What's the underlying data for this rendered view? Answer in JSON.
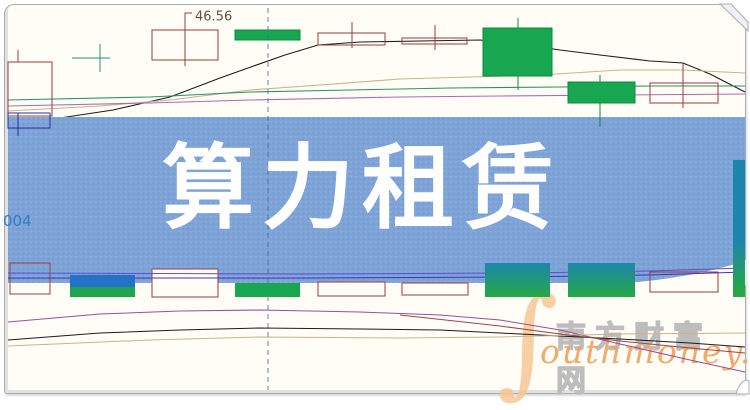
{
  "banner": {
    "title": "算力租赁",
    "bg": "#7da2d8",
    "text_color": "#ffffff"
  },
  "annotations": {
    "price_label": "46.56",
    "code_label": "004"
  },
  "watermark": {
    "swoosh": "∫",
    "cn": "南方财富网",
    "en": "outhmoney.com"
  },
  "colors": {
    "chart_bg": "#fffdf6",
    "frame": "#a8adb5",
    "banner": "#7da2d8",
    "up_outline": "#9a3c3a",
    "down_fill": "#18a750",
    "down_edge": "#0d8a3c",
    "navy": "#2b2f9e",
    "doji": "#2e8b80",
    "blue_bar": "#2472c8",
    "green_bar": "#1ea44e",
    "ma_black": "#1c1c1c",
    "ma_tan": "#c9b387",
    "ma_green": "#2f9068",
    "ma_pink": "#b06ab0",
    "purple1": "#5a4fd0",
    "purple2": "#3f35b5",
    "dashed": "#456e9e",
    "bot_purple": "#9a4f9a",
    "bot_black": "#1c1c1c",
    "bot_tan": "#c9b387",
    "bot_red": "#a04545",
    "label": "#6b4a45",
    "code": "#2a7fc0",
    "wm_orange": "#f0a25c",
    "wm_gray": "#bdbdbd"
  },
  "chart_data": {
    "type": "candlestick",
    "title": "算力租赁",
    "note": "Daily stock candlestick chart with MA lines; price axis hidden by blue banner overlay. Only visible price marker is 46.56. Coordinates below are pixel positions (y grows downward).",
    "visible_values": {
      "price_marker": 46.56
    },
    "banner_band": {
      "y": 117,
      "h": 166
    },
    "banner_curve_path": "M598,285 C660,282 715,272 746,260 L746,285 Z",
    "divider_x": 268,
    "price_leader": [
      [
        185,
        24
      ],
      [
        185,
        13
      ],
      [
        192,
        13
      ]
    ],
    "price_label_pos": [
      195,
      17
    ],
    "code_pos": [
      3,
      226
    ],
    "upper_lines": [
      {
        "name": "ma-black",
        "color": "ma_black",
        "points": [
          [
            8,
            124
          ],
          [
            60,
            118
          ],
          [
            113,
            110
          ],
          [
            170,
            97
          ],
          [
            220,
            78
          ],
          [
            248,
            68
          ],
          [
            285,
            55
          ],
          [
            318,
            45
          ],
          [
            360,
            42
          ],
          [
            420,
            41
          ],
          [
            480,
            40
          ],
          [
            520,
            44
          ],
          [
            560,
            50
          ],
          [
            600,
            55
          ],
          [
            650,
            61
          ],
          [
            683,
            63
          ],
          [
            710,
            74
          ],
          [
            745,
            92
          ]
        ]
      },
      {
        "name": "ma-tan",
        "color": "ma_tan",
        "points": [
          [
            8,
            111
          ],
          [
            100,
            106
          ],
          [
            170,
            100
          ],
          [
            250,
            90
          ],
          [
            320,
            85
          ],
          [
            400,
            79
          ],
          [
            470,
            77
          ],
          [
            540,
            75
          ],
          [
            620,
            70
          ],
          [
            683,
            70
          ],
          [
            745,
            73
          ]
        ]
      },
      {
        "name": "ma-green",
        "color": "ma_green",
        "points": [
          [
            8,
            100
          ],
          [
            150,
            97
          ],
          [
            250,
            92
          ],
          [
            350,
            90
          ],
          [
            450,
            88
          ],
          [
            560,
            87
          ],
          [
            650,
            86
          ],
          [
            745,
            86
          ]
        ]
      },
      {
        "name": "ma-pink",
        "color": "ma_pink",
        "points": [
          [
            8,
            106
          ],
          [
            150,
            103
          ],
          [
            250,
            100
          ],
          [
            400,
            97
          ],
          [
            500,
            96
          ],
          [
            620,
            95
          ],
          [
            745,
            94
          ]
        ]
      }
    ],
    "upper_candles": [
      {
        "kind": "up",
        "x": 8,
        "w": 44,
        "body": [
          62,
          116
        ],
        "wx": 18,
        "wick": [
          50,
          62
        ]
      },
      {
        "type": "doji",
        "hx": [
          72,
          110
        ],
        "hy": 58,
        "vx": 100,
        "vy": [
          44,
          72
        ]
      },
      {
        "kind": "up",
        "x": 152,
        "w": 66,
        "body": [
          30,
          60
        ],
        "wx": 185,
        "wick": [
          14,
          66
        ]
      },
      {
        "kind": "down",
        "x": 235,
        "w": 65,
        "body": [
          30,
          40
        ]
      },
      {
        "kind": "up",
        "x": 318,
        "w": 67,
        "body": [
          33,
          45
        ],
        "wx": 352,
        "wick": [
          22,
          48
        ]
      },
      {
        "kind": "up",
        "x": 402,
        "w": 65,
        "body": [
          38,
          44
        ],
        "wx": 435,
        "wick": [
          25,
          50
        ]
      },
      {
        "kind": "down",
        "x": 483,
        "w": 69,
        "body": [
          28,
          76
        ],
        "wx": 518,
        "wick": [
          18,
          90
        ]
      },
      {
        "kind": "down",
        "x": 568,
        "w": 67,
        "body": [
          82,
          103
        ],
        "wx": 600,
        "wick": [
          75,
          117
        ]
      },
      {
        "kind": "up",
        "x": 650,
        "w": 68,
        "body": [
          83,
          103
        ],
        "wx": 683,
        "wick": [
          63,
          108
        ]
      }
    ],
    "over_candles": [
      {
        "kind": "navy",
        "x": 8,
        "w": 42,
        "body": [
          113,
          128
        ],
        "wx": 18,
        "wick": [
          113,
          136
        ]
      },
      {
        "type": "seg",
        "x": 600,
        "y": [
          117,
          127
        ],
        "color": "down_edge"
      },
      {
        "kind": "grad",
        "x": 733,
        "w": 12,
        "body": [
          160,
          297
        ]
      }
    ],
    "purple_lines": [
      {
        "name": "overlay-line-1",
        "color": "purple1",
        "points": [
          [
            8,
            273
          ],
          [
            300,
            274
          ],
          [
            520,
            273
          ],
          [
            650,
            271
          ],
          [
            745,
            268
          ]
        ]
      },
      {
        "name": "overlay-line-2",
        "color": "purple2",
        "points": [
          [
            8,
            278
          ],
          [
            300,
            278
          ],
          [
            520,
            277
          ],
          [
            650,
            275
          ],
          [
            745,
            272
          ]
        ]
      }
    ],
    "lower_bars": [
      {
        "kind": "hollow",
        "fill": "none",
        "x": 10,
        "w": 40,
        "y": 263,
        "h": 31
      },
      {
        "kind": "bluegreen",
        "x": 70,
        "w": 65,
        "blue": [
          275,
          287
        ],
        "green": [
          287,
          297
        ]
      },
      {
        "kind": "hollow",
        "fill": "bg",
        "x": 152,
        "w": 66,
        "y": 269,
        "h": 28
      },
      {
        "kind": "green",
        "x": 235,
        "w": 65,
        "y": 283,
        "h": 14
      },
      {
        "kind": "hollow",
        "fill": "bg",
        "x": 318,
        "w": 67,
        "y": 282,
        "h": 14
      },
      {
        "kind": "hollow",
        "fill": "bg",
        "x": 402,
        "w": 66,
        "y": 283,
        "h": 12
      },
      {
        "kind": "grad",
        "x": 485,
        "w": 65,
        "y": 263,
        "h": 34
      },
      {
        "kind": "grad",
        "x": 568,
        "w": 67,
        "y": 263,
        "h": 34
      },
      {
        "kind": "hollow",
        "fill": "none",
        "x": 650,
        "w": 68,
        "y": 272,
        "h": 20
      }
    ],
    "lower_lines": [
      {
        "name": "ind-purple",
        "color": "bot_purple",
        "points": [
          [
            8,
            322
          ],
          [
            100,
            314
          ],
          [
            180,
            311
          ],
          [
            260,
            310
          ],
          [
            360,
            312
          ],
          [
            440,
            315
          ],
          [
            500,
            320
          ],
          [
            560,
            330
          ],
          [
            620,
            344
          ],
          [
            690,
            360
          ],
          [
            745,
            372
          ]
        ]
      },
      {
        "name": "ind-black",
        "color": "bot_black",
        "points": [
          [
            8,
            340
          ],
          [
            100,
            333
          ],
          [
            180,
            330
          ],
          [
            260,
            328
          ],
          [
            360,
            329
          ],
          [
            440,
            330
          ],
          [
            500,
            333
          ],
          [
            560,
            336
          ],
          [
            620,
            339
          ],
          [
            690,
            343
          ],
          [
            745,
            347
          ]
        ]
      },
      {
        "name": "ind-tan",
        "color": "bot_tan",
        "points": [
          [
            8,
            346
          ],
          [
            150,
            340
          ],
          [
            260,
            337
          ],
          [
            400,
            338
          ],
          [
            500,
            337
          ],
          [
            620,
            334
          ],
          [
            745,
            333
          ]
        ]
      },
      {
        "name": "ind-red",
        "color": "bot_red",
        "points": [
          [
            400,
            315
          ],
          [
            500,
            326
          ],
          [
            560,
            334
          ],
          [
            620,
            341
          ],
          [
            690,
            348
          ],
          [
            745,
            353
          ]
        ]
      }
    ]
  }
}
